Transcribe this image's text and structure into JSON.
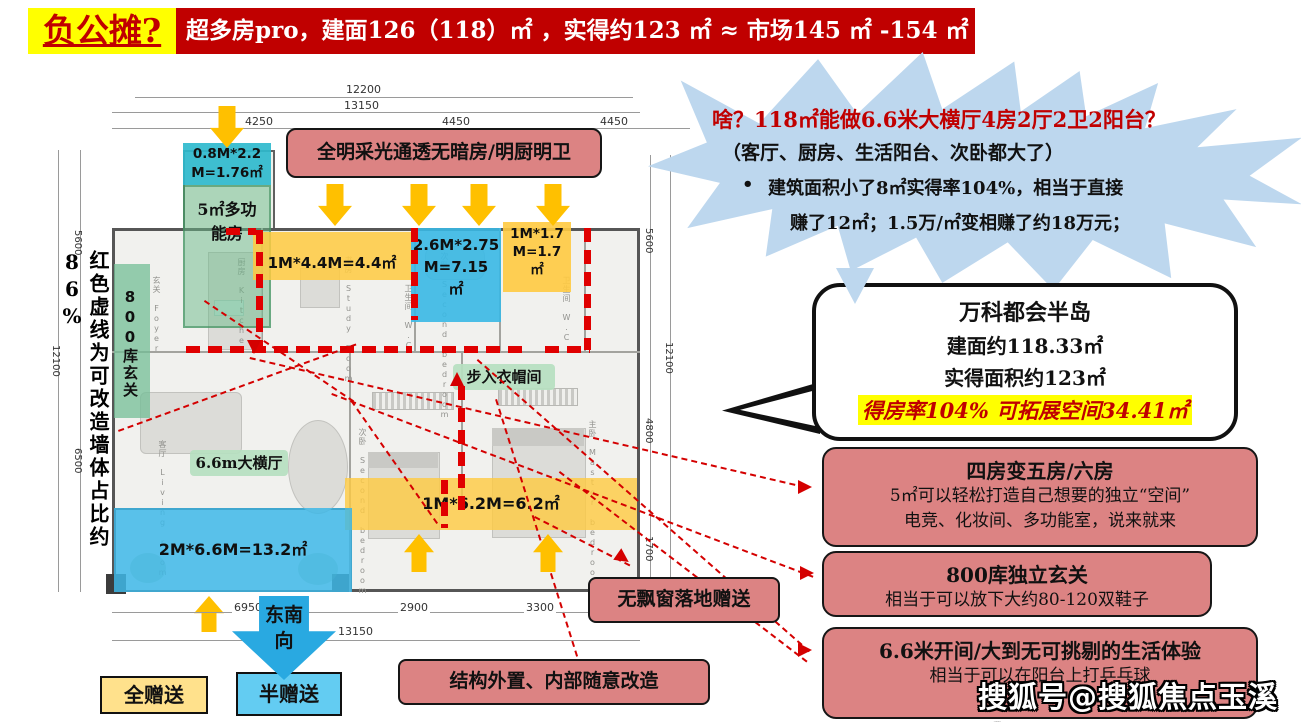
{
  "header": {
    "tag": "负公摊?",
    "banner": "超多房pro，建面126（118）㎡ ，实得约123 ㎡ ≈ 市场145 ㎡ -154 ㎡"
  },
  "dims": {
    "top_outer": "12200",
    "top_total": "13150",
    "top_segments": [
      "4250",
      "4450",
      "4450"
    ],
    "bottom_segments": [
      "6950",
      "2900",
      "3300"
    ],
    "bottom_total": "13150",
    "left": [
      "5600",
      "12100",
      "6500"
    ],
    "right": [
      "5600",
      "12100",
      "4800",
      "1700"
    ]
  },
  "plan": {
    "left_note": "红色虚线为可改造墙体占比约86%",
    "daylight_note": "全明采光通透无暗房/明厨明卫",
    "multi_dim": "0.8M*2.2\nM=1.76㎡",
    "multi_room": "5㎡多功\n能房",
    "entry": "800库玄关",
    "strip_44": "1M*4.4M=4.4㎡",
    "bath_715": "2.6M*2.75\nM=7.15\n㎡",
    "strip_17": "1M*1.7\nM=1.7\n㎡",
    "strip_62": "1M*6.2M=6.2㎡",
    "balcony": "2M*6.6M=13.2㎡",
    "living_label": "6.6m大横厅",
    "cloak_label": "步入衣帽间",
    "direction_l1": "东南",
    "direction_l2": "向",
    "rooms": [
      "玄关 Foyer",
      "厨房 Kitchen",
      "书房 Study Room",
      "卫生间 W.C",
      "次卧 Second bedroom",
      "卫生间 W.C",
      "次卧 Second bedroom",
      "主卧 Master bedroom",
      "客厅 Living room"
    ]
  },
  "starburst": {
    "q": "啥？118㎡能做6.6米大横厅4房2厅2卫2阳台？",
    "sub": "（客厅、厨房、生活阳台、次卧都大了）",
    "bullet_mark": "•",
    "bullet_l1": "建筑面积小了8㎡实得率104%，相当于直接",
    "bullet_l2": "赚了12㎡；1.5万/㎡变相赚了约18万元；"
  },
  "bubble": {
    "l1": "万科都会半岛",
    "l2": "建面约118.33㎡",
    "l3": "实得面积约123㎡",
    "highlight": "得房率104% 可拓展空间34.41㎡"
  },
  "benefits": [
    {
      "title": "四房变五房/六房",
      "lines": "5㎡可以轻松打造自己想要的独立“空间”\n电竞、化妆间、多功能室，说来就来"
    },
    {
      "title": "800库独立玄关",
      "lines": "相当于可以放下大约80-120双鞋子"
    },
    {
      "title": "6.6米开间/大到无可挑剔的生活体验",
      "lines": "相当于可以在阳台上打乒乓球"
    }
  ],
  "callouts": {
    "no_bay": "无飘窗落地赠送",
    "structure": "结构外置、内部随意改造"
  },
  "legend": {
    "full": "全赠送",
    "half": "半赠送"
  },
  "watermark": "搜狐号@搜狐焦点玉溪站",
  "colors": {
    "banner_red": "#C00000",
    "tag_yellow": "#FFFF00",
    "starburst_blue": "#BDD7EE",
    "callout_pink": "#DC8383",
    "overlay_yellow": "#FFCA40",
    "overlay_blue": "#38B8E4",
    "overlay_green": "#69B987",
    "overlay_cyan": "#2FBACD",
    "arrow_yellow": "#FFC000",
    "big_arrow_blue": "#29A9E1",
    "red_dash": "#E00000",
    "highlight_yellow": "#FFFF00",
    "legend_full": "#FFE18C",
    "legend_half": "#63CCF2"
  }
}
